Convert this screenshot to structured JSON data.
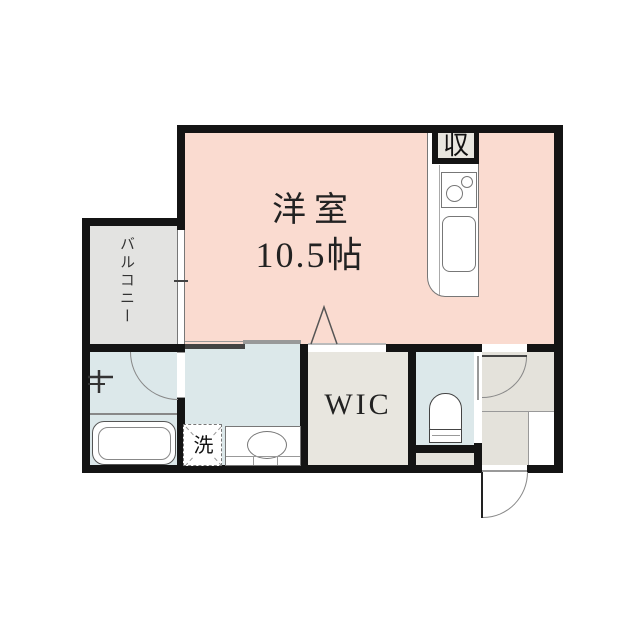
{
  "plan": {
    "type": "japanese-apartment-floor-plan",
    "labels": {
      "main_room": "洋室",
      "main_room_size": "10.5帖",
      "balcony": "バルコニー",
      "wic": "WIC",
      "washer": "洗",
      "storage": "収"
    },
    "rooms": [
      {
        "name": "western-room",
        "size_tatami": 10.5
      },
      {
        "name": "balcony"
      },
      {
        "name": "walk-in-closet"
      },
      {
        "name": "bathroom"
      },
      {
        "name": "washroom"
      },
      {
        "name": "toilet"
      },
      {
        "name": "entry-hall"
      },
      {
        "name": "kitchen"
      }
    ],
    "colors": {
      "room": "#fadbd0",
      "wet": "#dce8ea",
      "balcony": "#e3e3e1",
      "closet": "#e8e6df",
      "hall": "#e4e2db",
      "wall": "#141414"
    }
  }
}
